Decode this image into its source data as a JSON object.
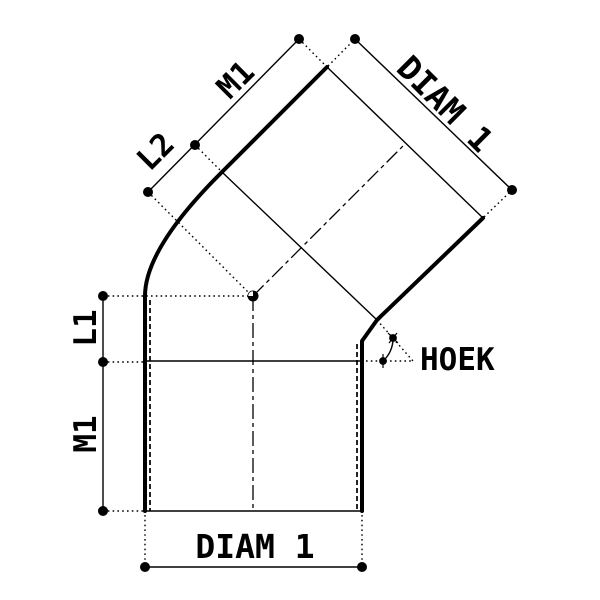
{
  "drawing": {
    "title": "45-degree pipe elbow fitting - dimensioned technical drawing",
    "background_color": "#ffffff",
    "stroke_color": "#000000",
    "labels": {
      "m1_top": "M1",
      "l2": "L2",
      "diam1_top": "DIAM 1",
      "l1": "L1",
      "m1_left": "M1",
      "diam1_bottom": "DIAM 1",
      "hoek": "HOEK"
    }
  }
}
